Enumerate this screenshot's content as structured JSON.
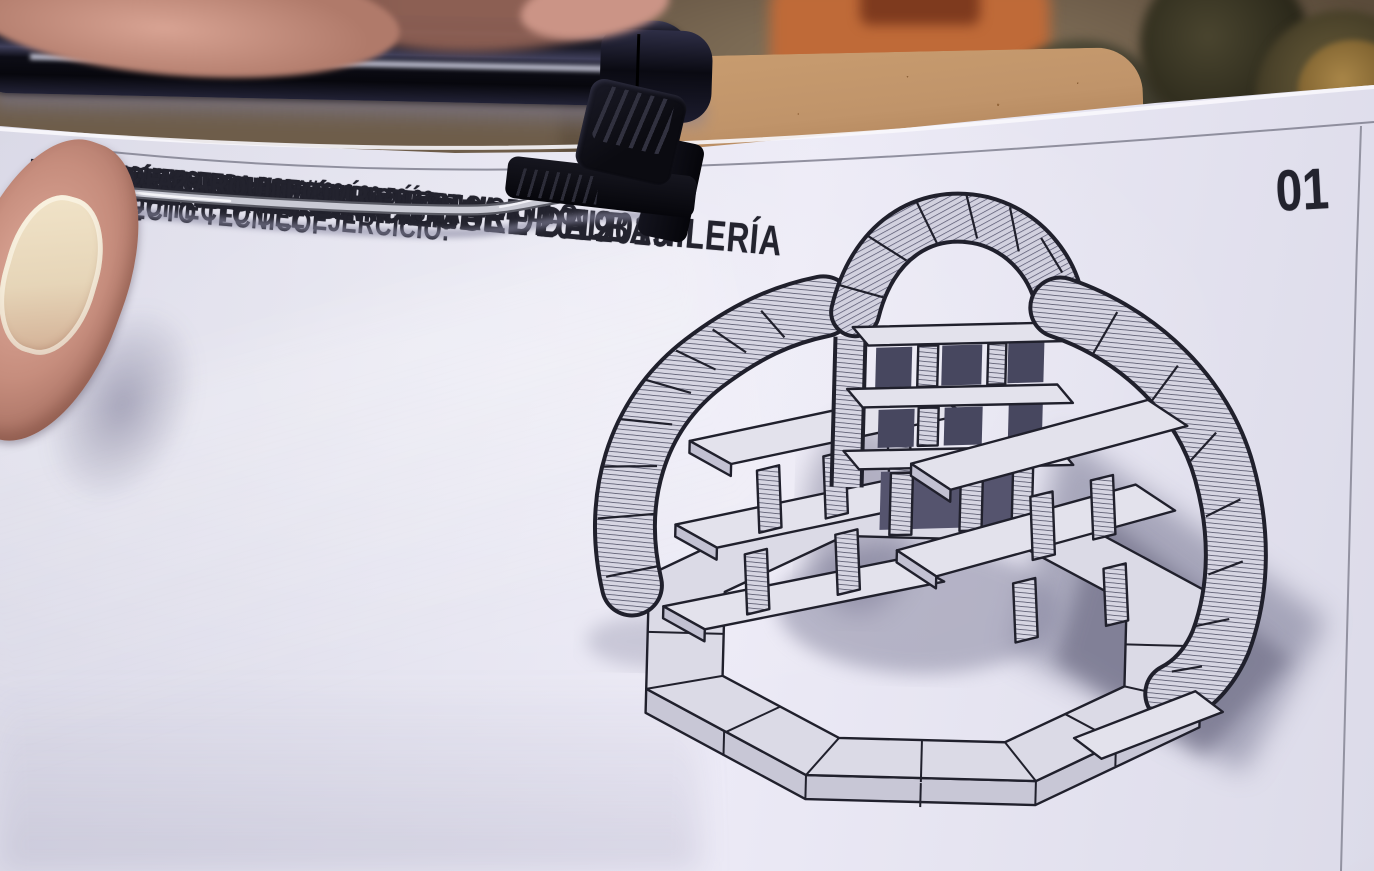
{
  "page": {
    "number": "01",
    "title": [
      "CONCURSO NACIONAL DE ALBAÑILERÍA",
      "FERIAS DE SAN MIGUEL 2019",
      "XXXIII EDICIÓN",
      "SÁBADO 28 SEPTIEMBRE DE 2019"
    ],
    "architect": [
      "ARQUITECTO DEL EJERCICIO:",
      "FRANCISCO JAVIER GONZÁLEZ MORILLO",
      "ESTUDIO:  BiMU ARQUITECTURA"
    ],
    "address": [
      "c/ GENERAL GUTIÉRREZ MELLADO N 3  1A",
      "NAVALMORAL DE LA MATA",
      "BIMUARQUITECTURA.COM // 636 30 53 33"
    ],
    "technical": [
      "ARQUITECTO TÉCNICO:",
      "ÓSCAR DEL CARMEN DOMÍNGUEZ",
      "ESTUDIO:  A2 ARQUITECTURA TÉCNICA"
    ]
  },
  "illustration": {
    "label": "Axonometric ink drawing of a circular brick structure with shelves on an octagonal base"
  },
  "colors": {
    "ink": "#23232e",
    "paper": "#e5e4f0",
    "cardboard": "#c0946a",
    "pen_barrel": "#161621",
    "clip_black": "#0b0b11",
    "wire_metal": "#c9cad4",
    "skin": "#cf9a8b",
    "nail": "#e6d5b8",
    "ground": "#6e5d4a",
    "brick_orange": "#bf6a38"
  }
}
